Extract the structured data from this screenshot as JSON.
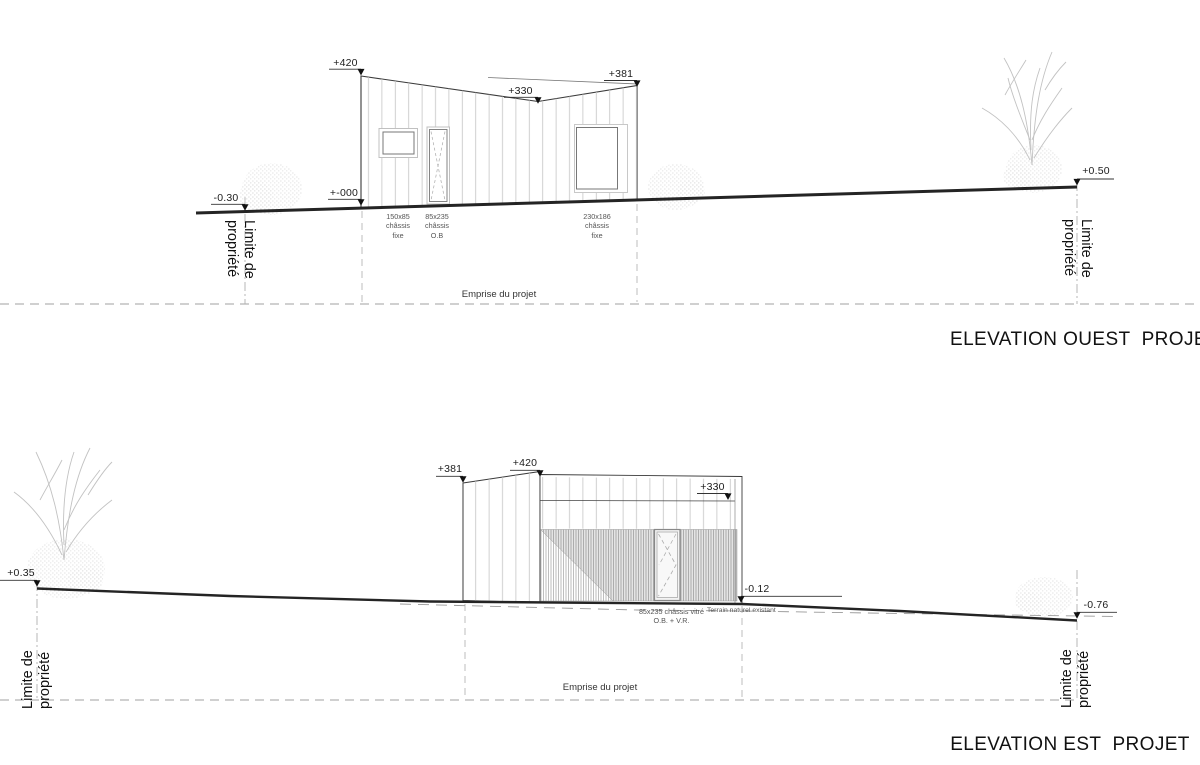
{
  "colors": {
    "ground_line": "#242424",
    "drawing_line": "#3a3a3a",
    "siding_line": "#c4c4c4",
    "dashed_guide": "#b5b5b5",
    "annotation_text": "#555555"
  },
  "ouest": {
    "title": "ELEVATION OUEST  PROJET",
    "markers": {
      "top_left": "+420",
      "roof_mid": "+330",
      "top_right": "+381",
      "base": "+-000",
      "ground_left": "-0.30",
      "ground_right": "+0.50"
    },
    "annotations": {
      "window_left": "150x85\nchâssis\nfixe",
      "door": "85x235\nchâssis\nO.B",
      "window_right": "230x186\nchâssis\nfixe"
    },
    "emprise_label": "Emprise du projet",
    "property_label": "Limite de\npropriété"
  },
  "est": {
    "title": "ELEVATION EST  PROJET",
    "markers": {
      "wing_left": "+381",
      "peak": "+420",
      "roof_right": "+330",
      "base_right": "-0.12",
      "ground_left": "+0.35",
      "ground_right": "-0.76"
    },
    "annotations": {
      "door": "85x235 châssis vitré\nO.B. + V.R.",
      "terrain": "Terrain naturel existant"
    },
    "emprise_label": "Emprise du projet",
    "property_label": "Limite de\npropriété"
  }
}
